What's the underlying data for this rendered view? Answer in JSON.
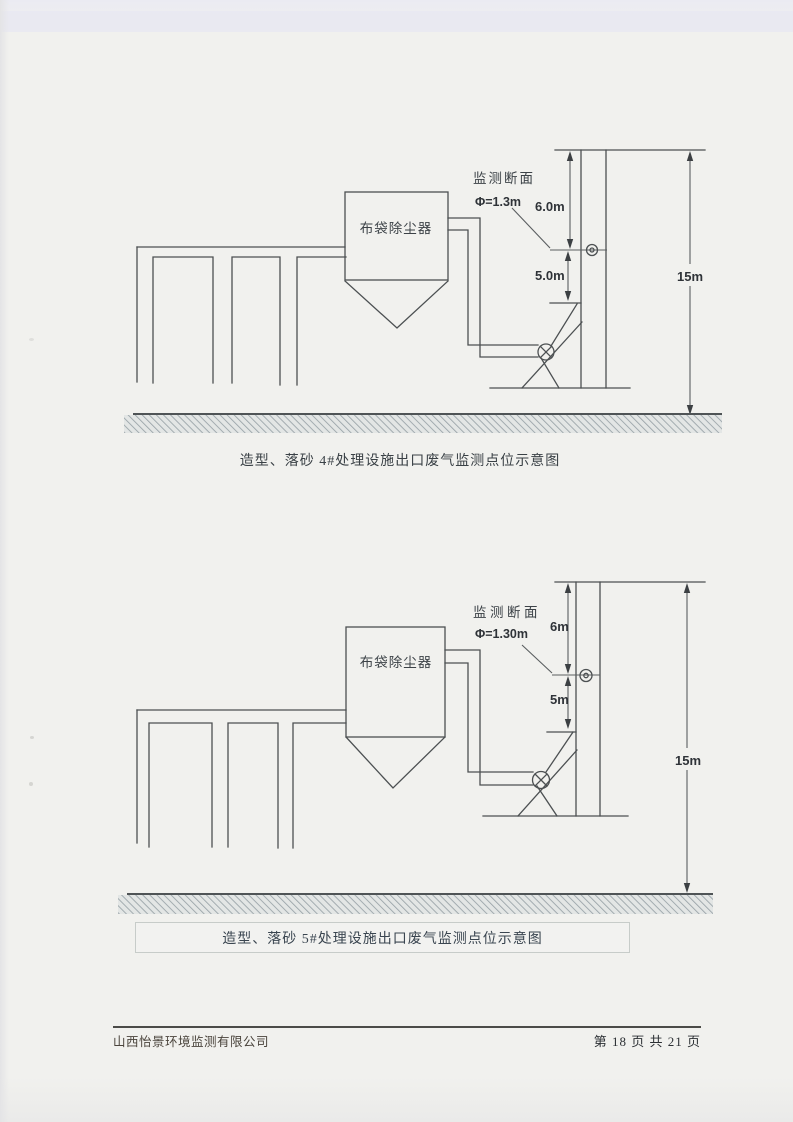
{
  "page": {
    "background_color": "#f1f1ee",
    "line_color": "#4c5052",
    "footer": {
      "company": "山西怡景环境监测有限公司",
      "page_info": "第 18 页 共 21 页"
    }
  },
  "diagram_top": {
    "equipment_label": "布袋除尘器",
    "monitoring_section": {
      "label": "监测断面",
      "diameter": "Φ=1.3m"
    },
    "dimensions": {
      "above_port": "6.0m",
      "below_port": "5.0m",
      "stack_height": "15m"
    },
    "caption": "造型、落砂 4#处理设施出口废气监测点位示意图"
  },
  "diagram_bottom": {
    "equipment_label": "布袋除尘器",
    "monitoring_section": {
      "label": "监测断面",
      "diameter": "Φ=1.30m"
    },
    "dimensions": {
      "above_port": "6m",
      "below_port": "5m",
      "stack_height": "15m"
    },
    "caption": "造型、落砂 5#处理设施出口废气监测点位示意图"
  }
}
